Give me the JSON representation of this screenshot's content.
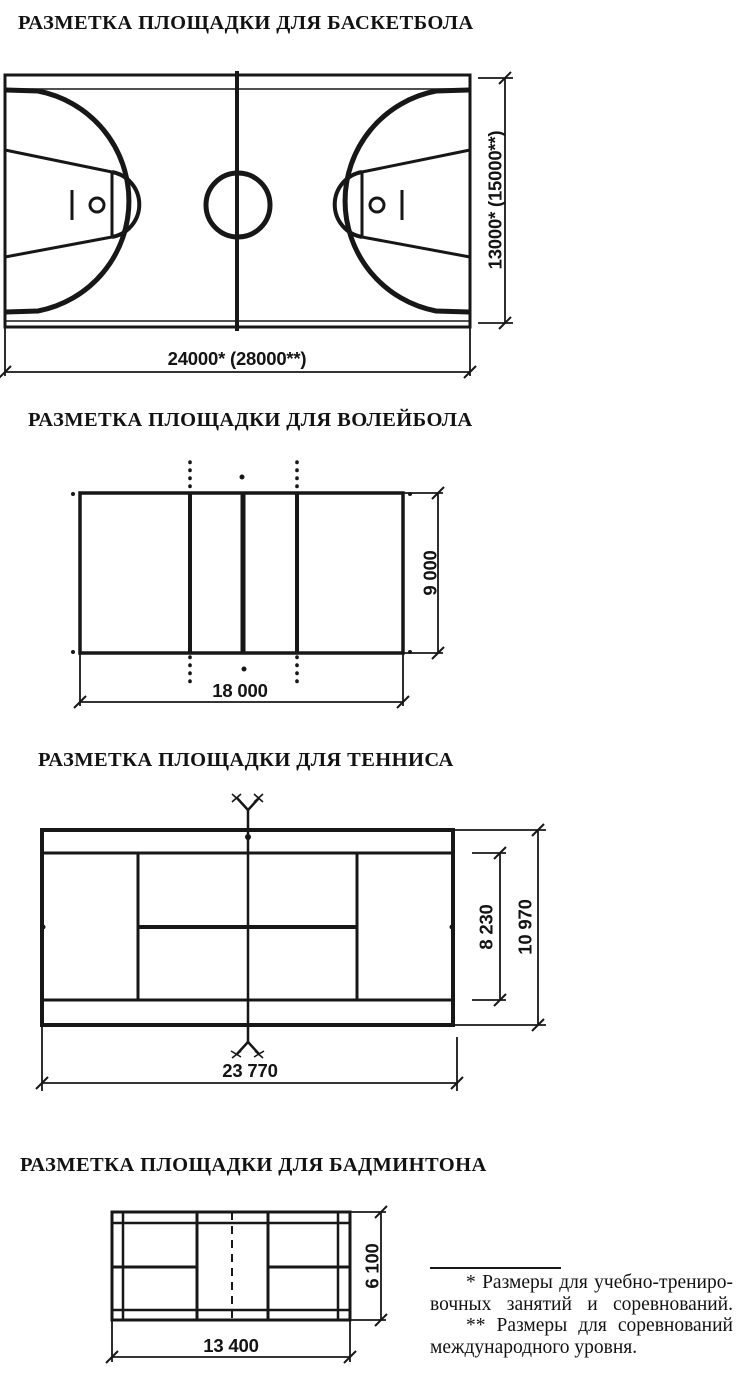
{
  "document": {
    "language": "ru",
    "background_color": "#ffffff",
    "ink_color": "#171717"
  },
  "sections": {
    "basketball": {
      "title": "РАЗМЕТКА ПЛОЩАДКИ ДЛЯ БАСКЕТБОЛА",
      "width_label": "24000* (28000**)",
      "height_label": "13000* (15000**)"
    },
    "volleyball": {
      "title": "РАЗМЕТКА ПЛОЩАДКИ ДЛЯ ВОЛЕЙБОЛА",
      "width_label": "18 000",
      "height_label": "9 000"
    },
    "tennis": {
      "title": "РАЗМЕТКА ПЛОЩАДКИ ДЛЯ ТЕННИСА",
      "width_label": "23 770",
      "height_label": "10 970",
      "singles_width_label": "8 230"
    },
    "badminton": {
      "title": "РАЗМЕТКА ПЛОЩАДКИ ДЛЯ БАДМИНТОНА",
      "width_label": "13 400",
      "height_label": "6 100"
    }
  },
  "footnotes": {
    "lines": [
      "* Размеры для учебно-трениро-",
      "вочных занятий и соревнований.",
      "** Размеры для соревнований",
      "международного уровня."
    ]
  }
}
